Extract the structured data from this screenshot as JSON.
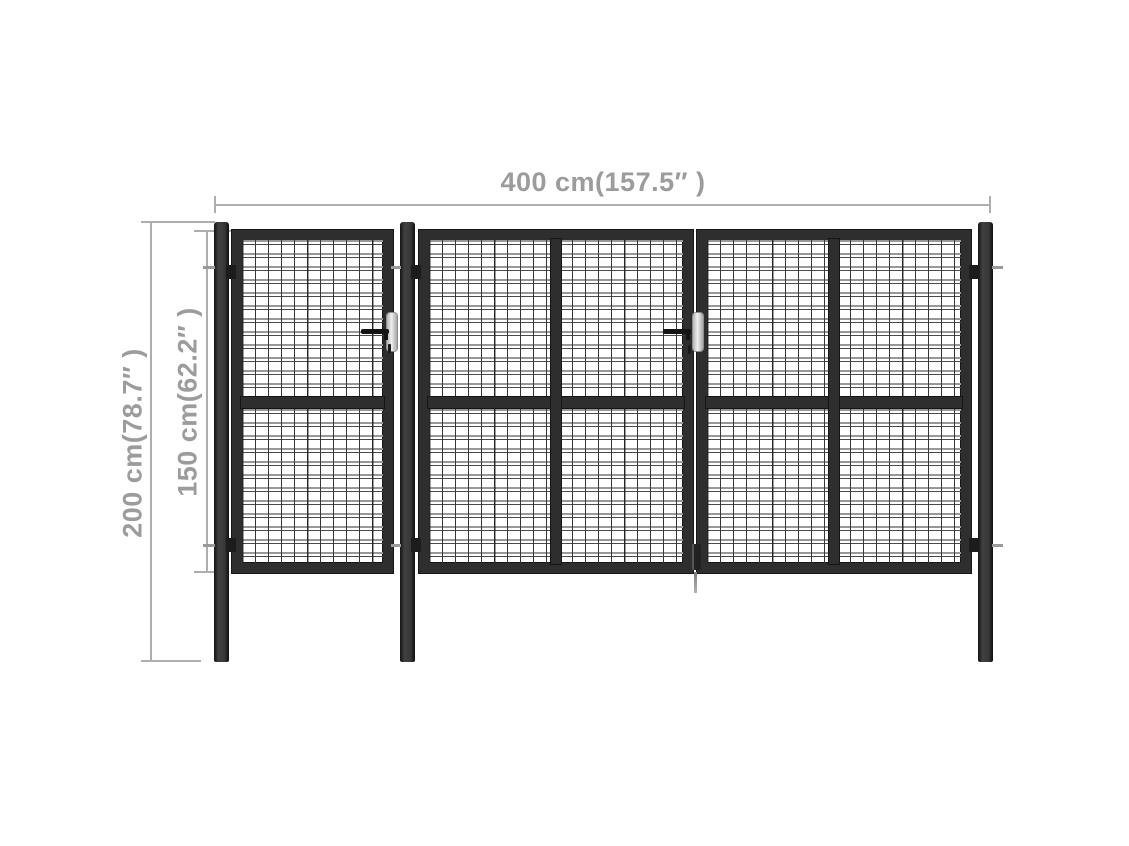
{
  "image_type": "product-dimension-diagram",
  "subject": "steel mesh garden gate with double leaf, pedestrian leaf and three posts",
  "dimensions": {
    "width_label": "400 cm(157.5″ )",
    "post_height_label": "200 cm(78.7″ )",
    "gate_height_label": "150 cm(62.2″ )"
  },
  "structure": {
    "posts_count": 3,
    "panels": [
      "pedestrian-leaf",
      "double-gate-left-leaf",
      "double-gate-right-leaf"
    ],
    "handles_count": 2,
    "hinges_count": 6
  },
  "colors": {
    "background": "#ffffff",
    "steel_dark": "#2e2e2e",
    "mesh_wire_dark": "#3a3a3a",
    "mesh_wire_light": "#989898",
    "dimension_gray": "#9c9c9c",
    "latch_plate": "#d9d9d9"
  }
}
